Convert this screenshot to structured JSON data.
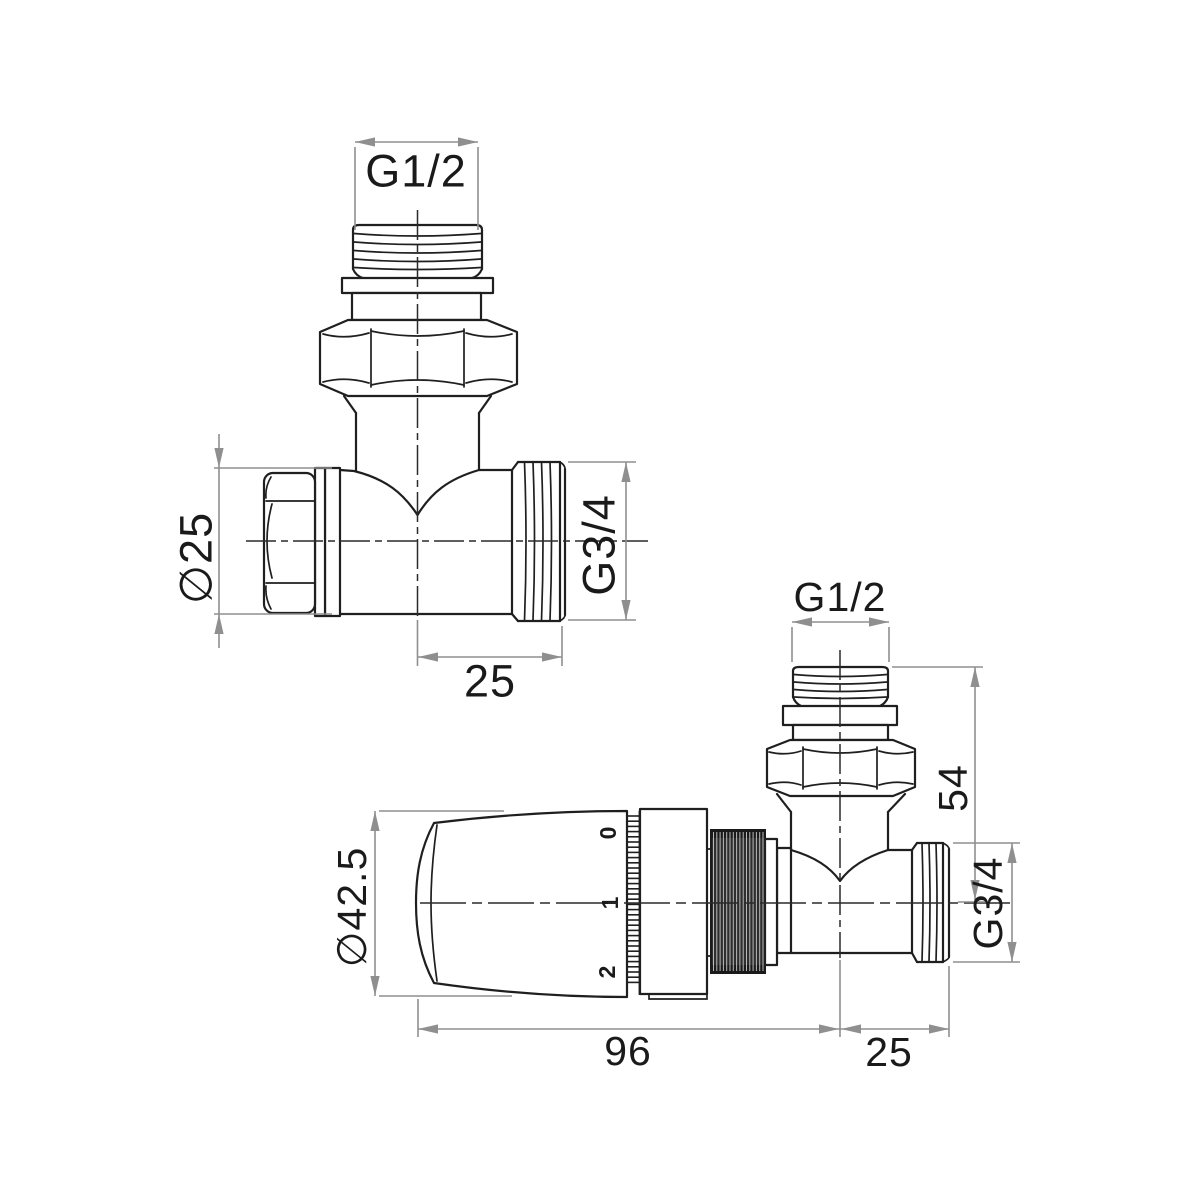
{
  "drawing": {
    "background": "#ffffff",
    "line_color": "#1f1f1f",
    "dimension_color": "#8f8f8f",
    "views": {
      "angled_valve": {
        "dimensions": {
          "top_thread": "G1/2",
          "cap_diameter": "∅25",
          "side_thread": "G3/4",
          "port_length": "25"
        }
      },
      "thermostatic_valve": {
        "dimensions": {
          "top_thread": "G1/2",
          "top_height": "54",
          "side_thread": "G3/4",
          "head_diameter": "∅42.5",
          "total_length": "96",
          "port_length": "25"
        },
        "head_scale_marks": [
          "0",
          "1",
          "2"
        ]
      }
    }
  }
}
